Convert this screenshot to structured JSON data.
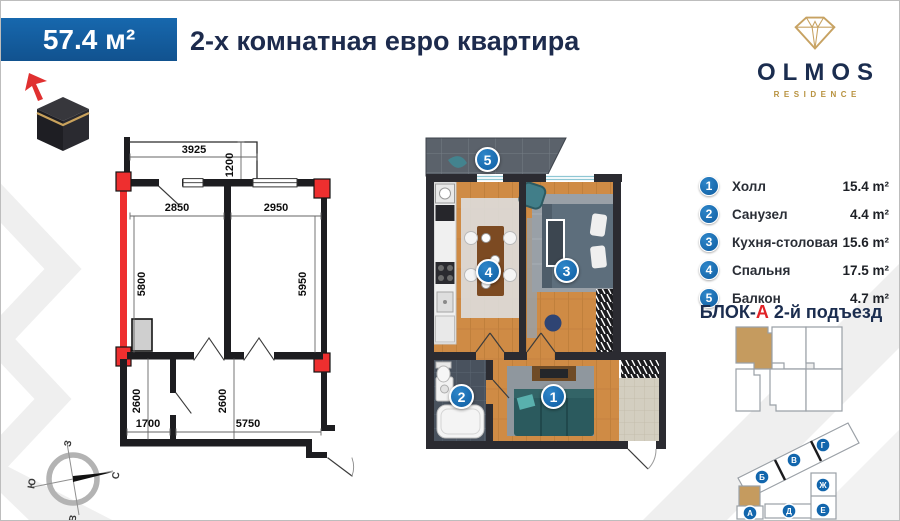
{
  "header": {
    "area": "57.4 м²",
    "title": "2-х комнатная евро квартира"
  },
  "logo": {
    "brand": "OLMOS",
    "tagline": "RESIDENCE"
  },
  "legend": {
    "items": [
      {
        "num": "1",
        "label": "Холл",
        "area": "15.4 m²"
      },
      {
        "num": "2",
        "label": "Санузел",
        "area": "4.4 m²"
      },
      {
        "num": "3",
        "label": "Кухня-столовая",
        "area": "15.6 m²"
      },
      {
        "num": "4",
        "label": "Спальня",
        "area": "17.5 m²"
      },
      {
        "num": "5",
        "label": "Балкон",
        "area": "4.7 m²"
      }
    ]
  },
  "block_info": {
    "prefix": "БЛОК-",
    "letter": "А",
    "suffix": " 2-й подъезд"
  },
  "tech_dims": {
    "balcony_w": "3925",
    "balcony_d": "1200",
    "left_room_w": "2850",
    "right_room_w": "2950",
    "left_room_h": "5800",
    "right_room_h": "5950",
    "bath_h": "2600",
    "bath_w": "1700",
    "hall_h": "2600",
    "hall_w": "5750"
  },
  "site_blocks": {
    "a": "А",
    "b": "Б",
    "v": "В",
    "g": "Г",
    "d": "Д",
    "e": "Е",
    "zh": "Ж"
  },
  "compass": {
    "north": "С",
    "south": "Ю",
    "west": "З",
    "east": "В"
  },
  "colors": {
    "accent_blue": "#1563a6",
    "badge_blue": "#1266ad",
    "brand_navy": "#1b2d4f",
    "gold": "#b8923f",
    "red": "#e8262a",
    "wall": "#2b2b31",
    "wood": "#cf8b45",
    "highlight_tan": "#c59b5f"
  }
}
